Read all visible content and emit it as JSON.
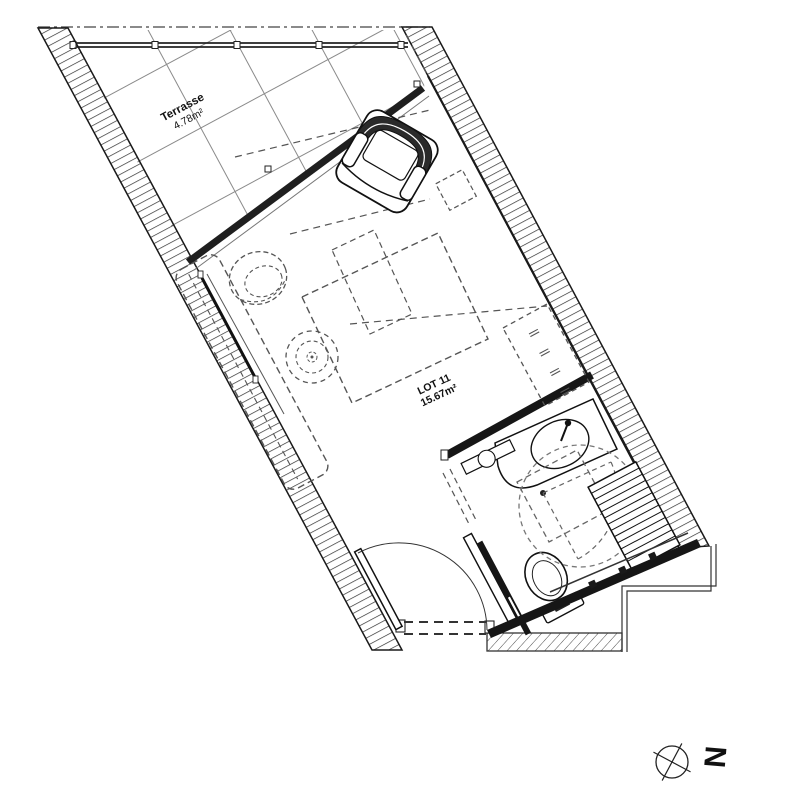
{
  "plan": {
    "title": "floor-plan-lot-11",
    "terrace": {
      "label": "Terrasse",
      "area": "4.78m²"
    },
    "lot": {
      "label": "LOT 11",
      "area": "15.67m²"
    },
    "north": {
      "letter": "N"
    },
    "colors": {
      "ink": "#1a1a1a",
      "wall_fill": "#2e2e2e",
      "dashed": "#555555",
      "tile_line": "#8a8a8a",
      "background": "#ffffff"
    }
  }
}
